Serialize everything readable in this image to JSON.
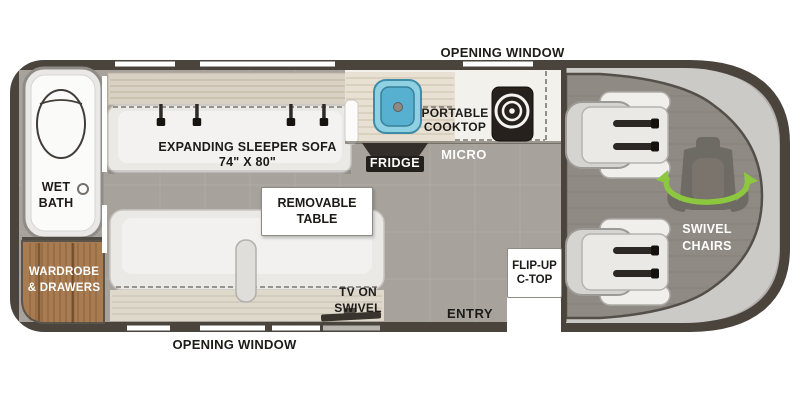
{
  "plan": {
    "windows": {
      "top_label": "OPENING WINDOW",
      "bottom_label": "OPENING WINDOW"
    },
    "bath": {
      "label": "WET\nBATH"
    },
    "wardrobe": {
      "label": "WARDROBE\n& DRAWERS"
    },
    "sofa": {
      "label": "EXPANDING SLEEPER SOFA\n74\" X 80\""
    },
    "table": {
      "label": "REMOVABLE\nTABLE"
    },
    "tv": {
      "label": "TV ON\nSWIVEL"
    },
    "kitchen": {
      "fridge_label": "FRIDGE",
      "micro_label": "MICRO",
      "cooktop_label": "PORTABLE\nCOOKTOP"
    },
    "flip_up_counter": {
      "label": "FLIP-UP\nC-TOP"
    },
    "entry": {
      "label": "ENTRY"
    },
    "cab": {
      "chairs_label": "SWIVEL\nCHAIRS"
    }
  },
  "icons": {
    "toilet": "toilet-icon",
    "drain": "drain-icon",
    "sink": "sink-icon",
    "burner": "cooktop-burner-icon",
    "seatbelt": "seatbelt-clip-icon",
    "swivel_chair": "swivel-chair-icon",
    "swivel_arrows": "swivel-arrows-icon",
    "tv": "tv-icon"
  },
  "colors": {
    "wall": "#4a443d",
    "body_gray": "#b3b0ac",
    "floor": "#a7a29b",
    "cab_floor": "#8f8a83",
    "windshield": "#cccac6",
    "counter_wood": "#e8e1d3",
    "wardrobe_wood": "#a87c50",
    "sink_blue": "#8fd0e2",
    "sink_blue_deep": "#57b0cf",
    "accent_green": "#8dc63f",
    "label_dark": "#1d1b18",
    "label_light": "#fdfdfc"
  }
}
